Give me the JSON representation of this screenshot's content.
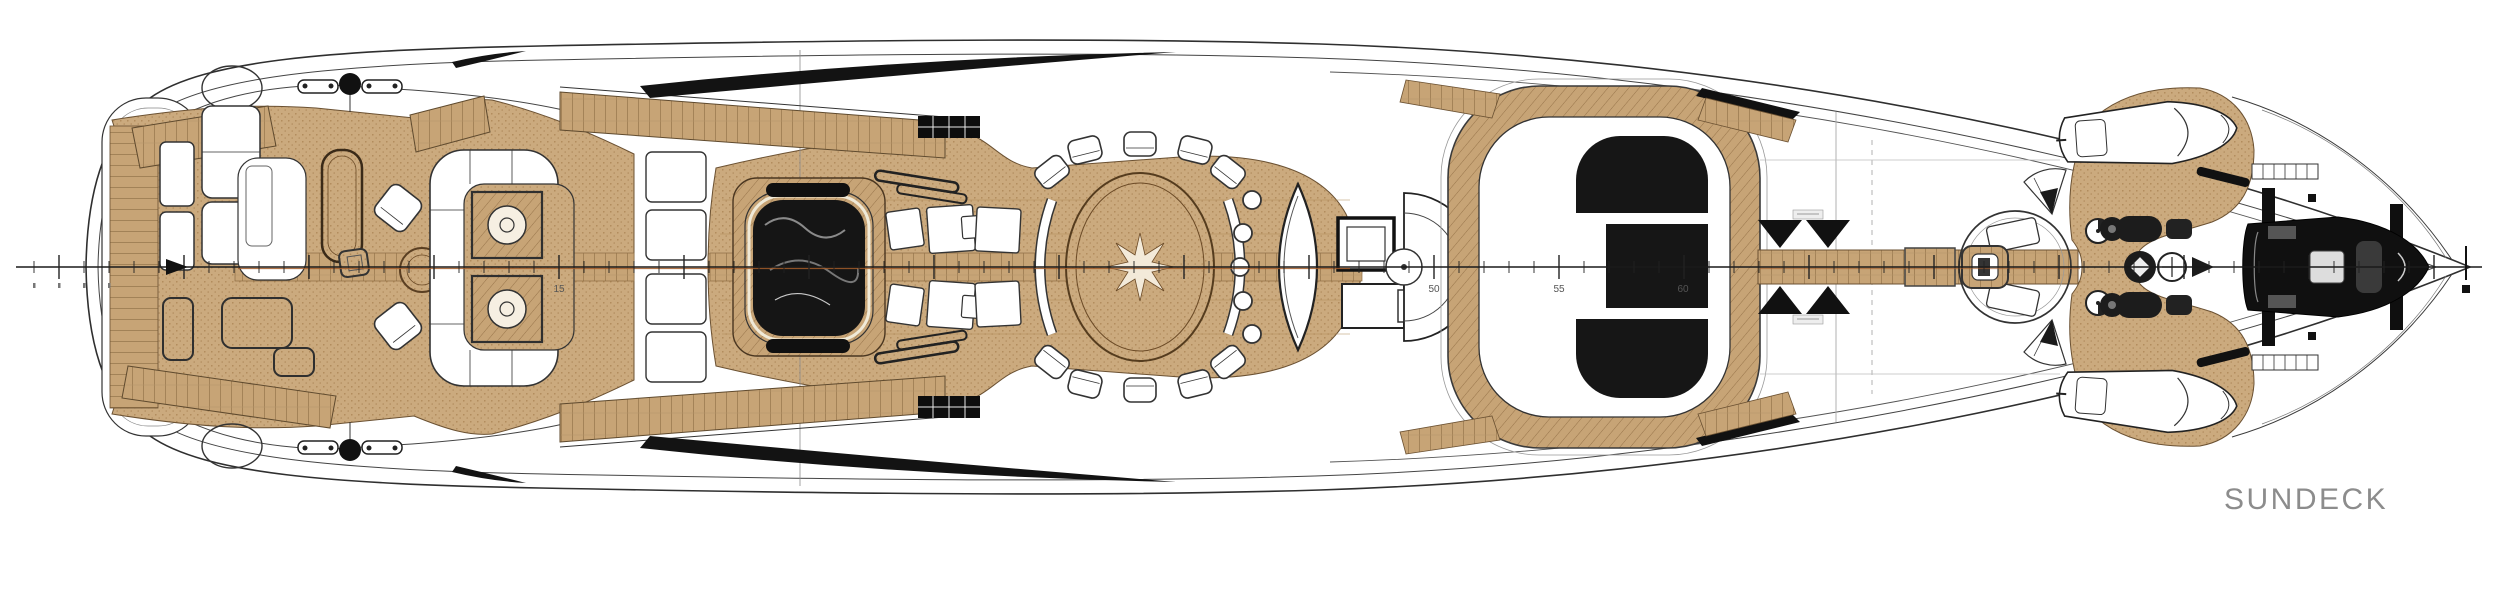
{
  "deck": {
    "label": "SUNDECK"
  },
  "centerline": {
    "station_labels": [
      {
        "value": "15"
      },
      {
        "value": "50"
      },
      {
        "value": "55"
      },
      {
        "value": "60"
      }
    ]
  },
  "colors": {
    "teak": "#c9a77b",
    "teak_line": "#8d6d44",
    "outline": "#333333",
    "glass_black": "#161616",
    "water_black": "#151515",
    "centerline_accent": "#a35c2a",
    "label_gray": "#8c8c8c"
  },
  "features": {
    "aft_deck": [
      "side-deck-planks",
      "mooring-cleats",
      "stern-stairs",
      "deck-lockers",
      "lounge-sofa",
      "stair-void",
      "cocktail-table",
      "stool",
      "armchairs",
      "round-table",
      "u-shaped-sofa",
      "lamp-tables"
    ],
    "midship": [
      "sun-pads",
      "jacuzzi",
      "teak-walkways",
      "skylight-slivers",
      "pergola-grate",
      "hatch-rails",
      "sun-pad-cluster",
      "dining-table",
      "compass-inlay",
      "dining-chairs",
      "curved-benches",
      "bar-stools",
      "bar-counter",
      "tv-console",
      "spiral-stair"
    ],
    "forward": [
      "hardtop-roof",
      "glass-skylight",
      "crane-arms",
      "catwalk",
      "mast-platform",
      "foredeck-teak",
      "tender-boats",
      "capstans",
      "jet-skis",
      "windlass",
      "grab-rails",
      "boarding-ladders",
      "rescue-tender",
      "davit-cradle",
      "bow-tip"
    ]
  }
}
